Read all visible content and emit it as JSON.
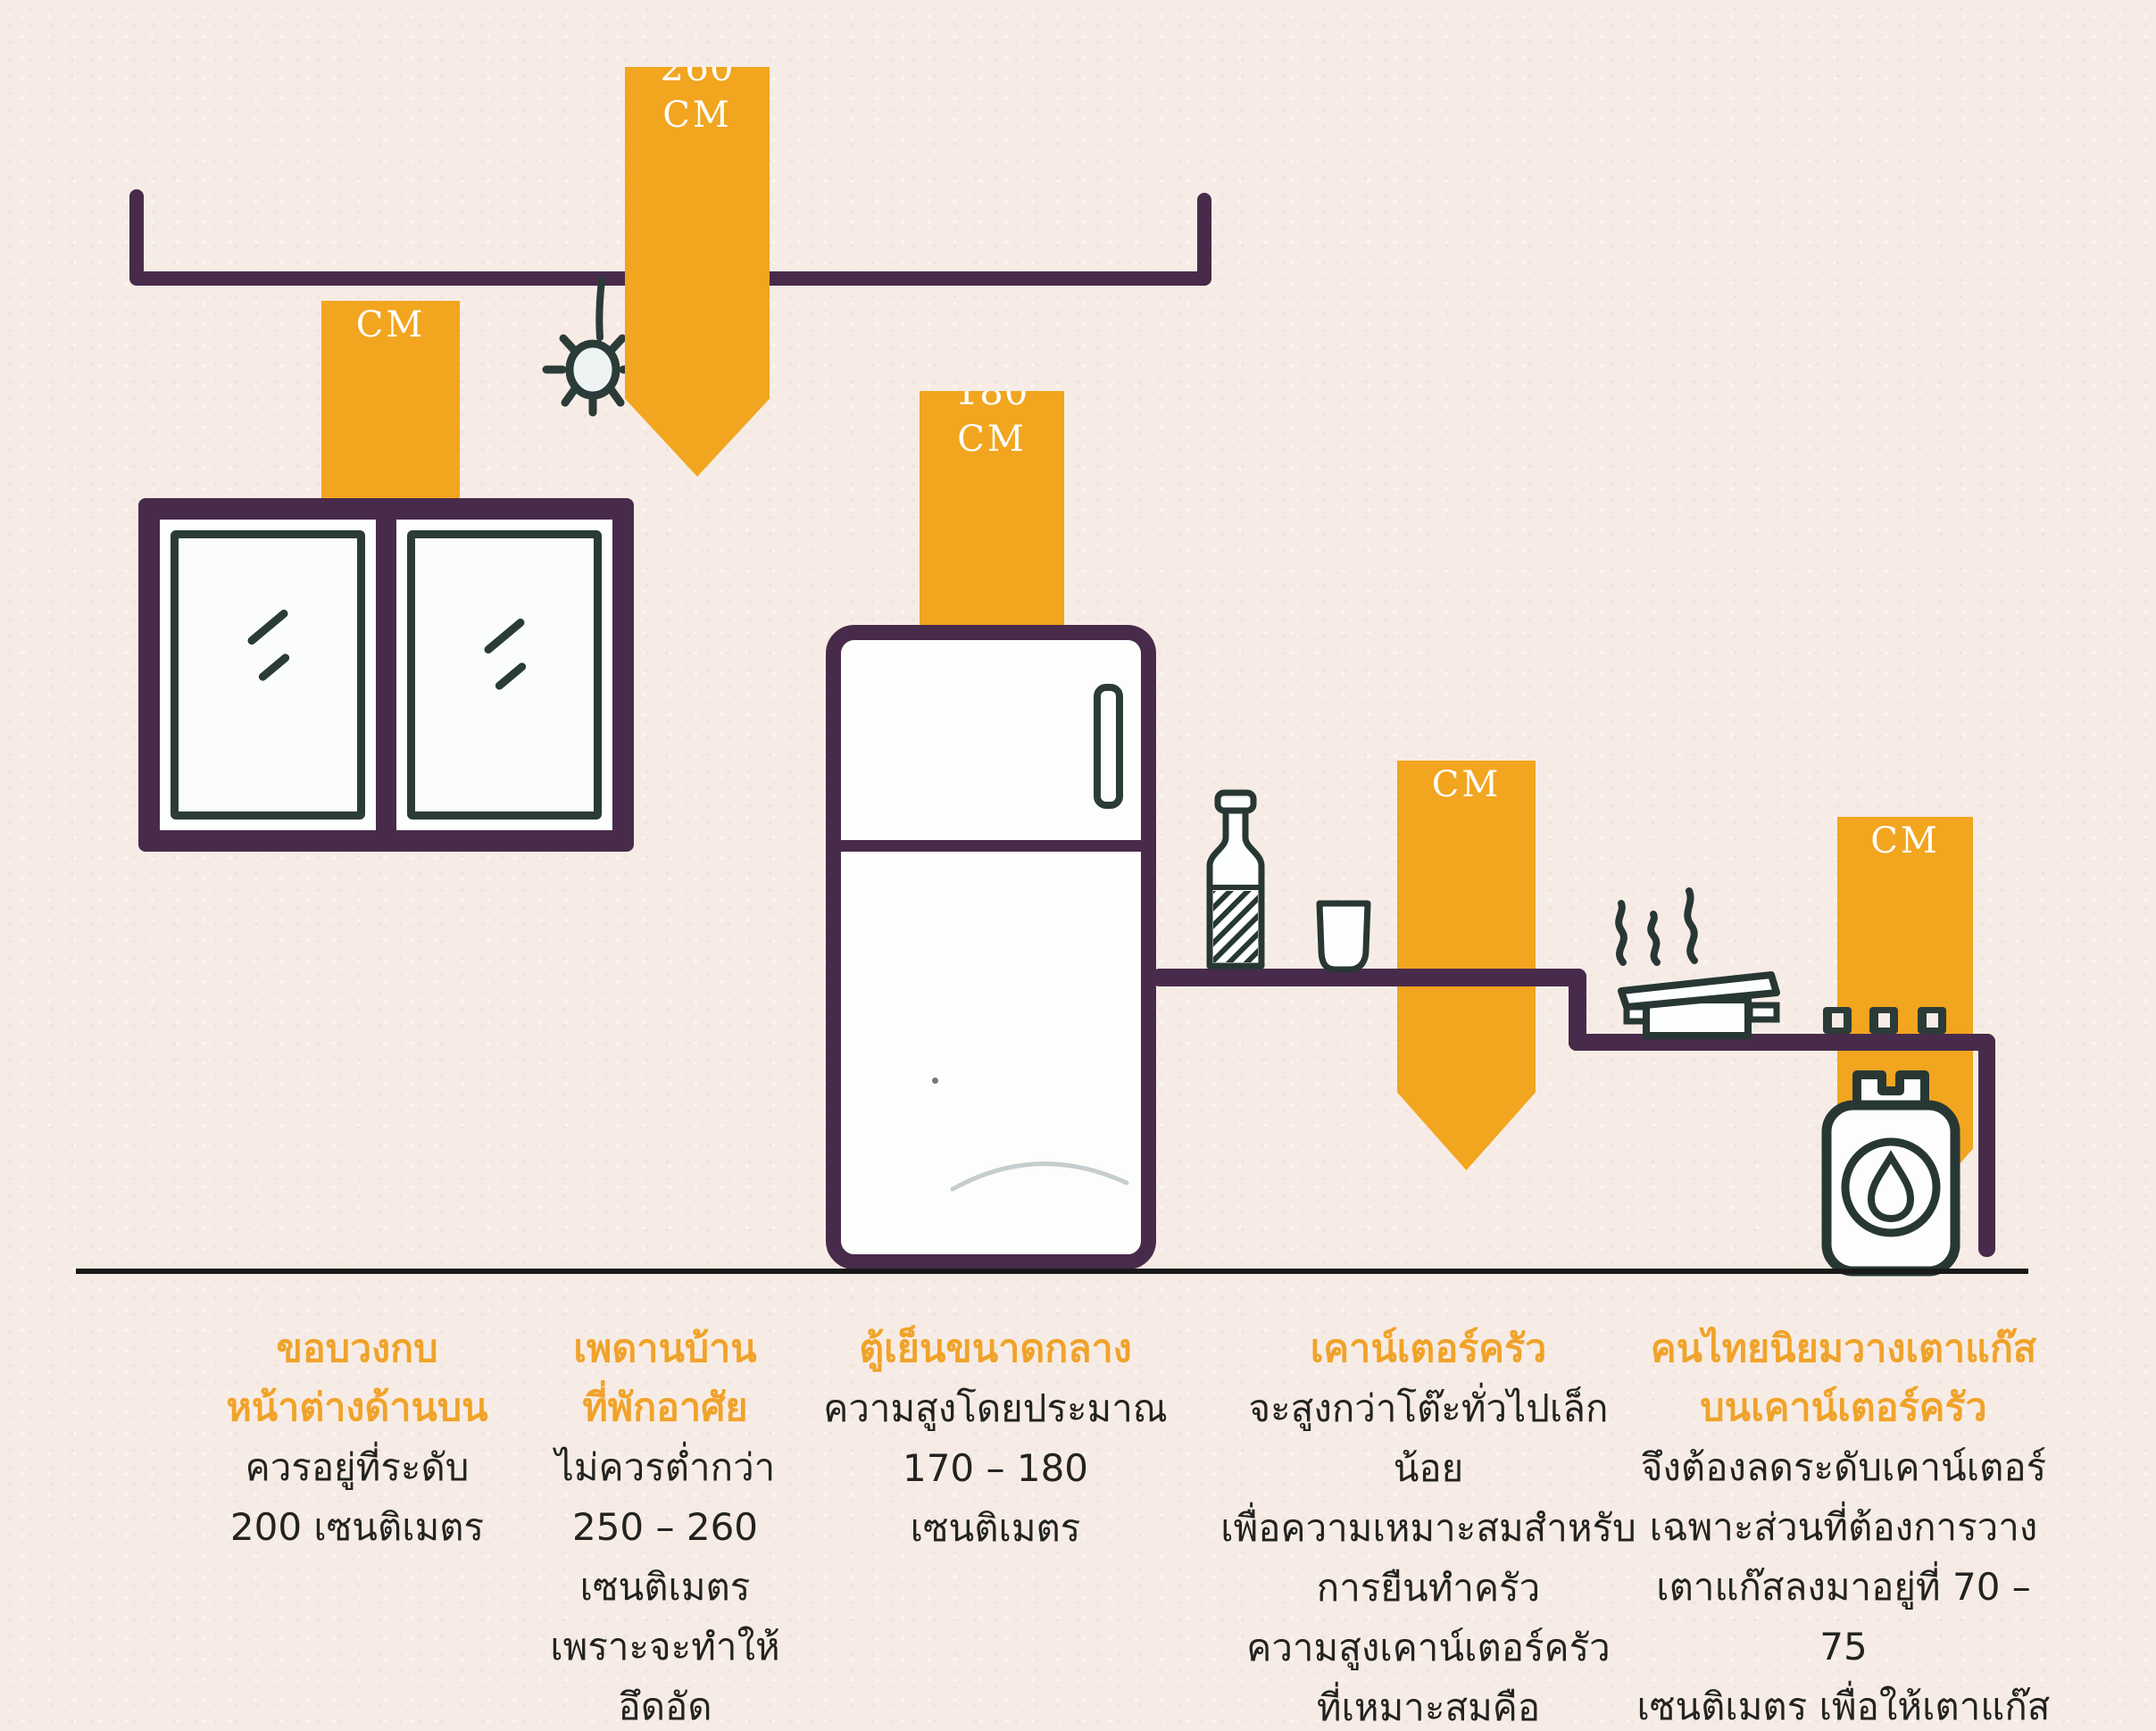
{
  "diagram": {
    "badges": [
      {
        "id": "ceiling-height",
        "value": "250-260",
        "unit": "CM"
      },
      {
        "id": "window-top-height",
        "value": "200",
        "unit": "CM"
      },
      {
        "id": "fridge-height",
        "value": "170-180",
        "unit": "CM"
      },
      {
        "id": "counter-height",
        "value": "80-85",
        "unit": "CM"
      },
      {
        "id": "stove-counter-height",
        "value": "70-75",
        "unit": "CM"
      }
    ],
    "objects": [
      "ceiling-line",
      "light-bulb",
      "window",
      "fridge",
      "bottle",
      "cup",
      "kitchen-counter",
      "steam",
      "pot",
      "stove-knobs",
      "gas-cylinder",
      "ground-line"
    ],
    "colors": {
      "badge_orange": "#f2a51f",
      "line_purple": "#482b4b",
      "sketch_ink": "#2b3b38",
      "paper_background": "#f7ece5",
      "ground_black": "#1a1a18",
      "header_orange": "#f0a32a",
      "body_text": "#232321"
    }
  },
  "legend": {
    "columns": [
      {
        "title_lines": [
          "ขอบวงกบ",
          "หน้าต่างด้านบน"
        ],
        "body_lines": [
          "ควรอยู่ที่ระดับ",
          "200 เซนติเมตร"
        ]
      },
      {
        "title_lines": [
          "เพดานบ้าน",
          "ที่พักอาศัย"
        ],
        "body_lines": [
          "ไม่ควรต่ำกว่า",
          "250 – 260 เซนติเมตร",
          "เพราะจะทำให้อึดอัด"
        ]
      },
      {
        "title_lines": [
          "ตู้เย็นขนาดกลาง"
        ],
        "body_lines": [
          "ความสูงโดยประมาณ",
          "170 – 180 เซนติเมตร"
        ]
      },
      {
        "title_lines": [
          "เคาน์เตอร์ครัว"
        ],
        "body_lines": [
          "จะสูงกว่าโต๊ะทั่วไปเล็กน้อย",
          "เพื่อความเหมาะสมสำหรับ",
          "การยืนทำครัว",
          "ความสูงเคาน์เตอร์ครัว",
          "ที่เหมาะสมคือ",
          "80 – 85 เซนติเมตร"
        ]
      },
      {
        "title_lines": [
          "คนไทยนิยมวางเตาแก๊ส",
          "บนเคาน์เตอร์ครัว"
        ],
        "body_lines": [
          "จึงต้องลดระดับเคาน์เตอร์",
          "เฉพาะส่วนที่ต้องการวาง",
          "เตาแก๊สลงมาอยู่ที่ 70 – 75",
          "เซนติเมตร  เพื่อให้เตาแก๊ส",
          "อยู่ในระดับที่เหมาะสม"
        ]
      }
    ]
  }
}
